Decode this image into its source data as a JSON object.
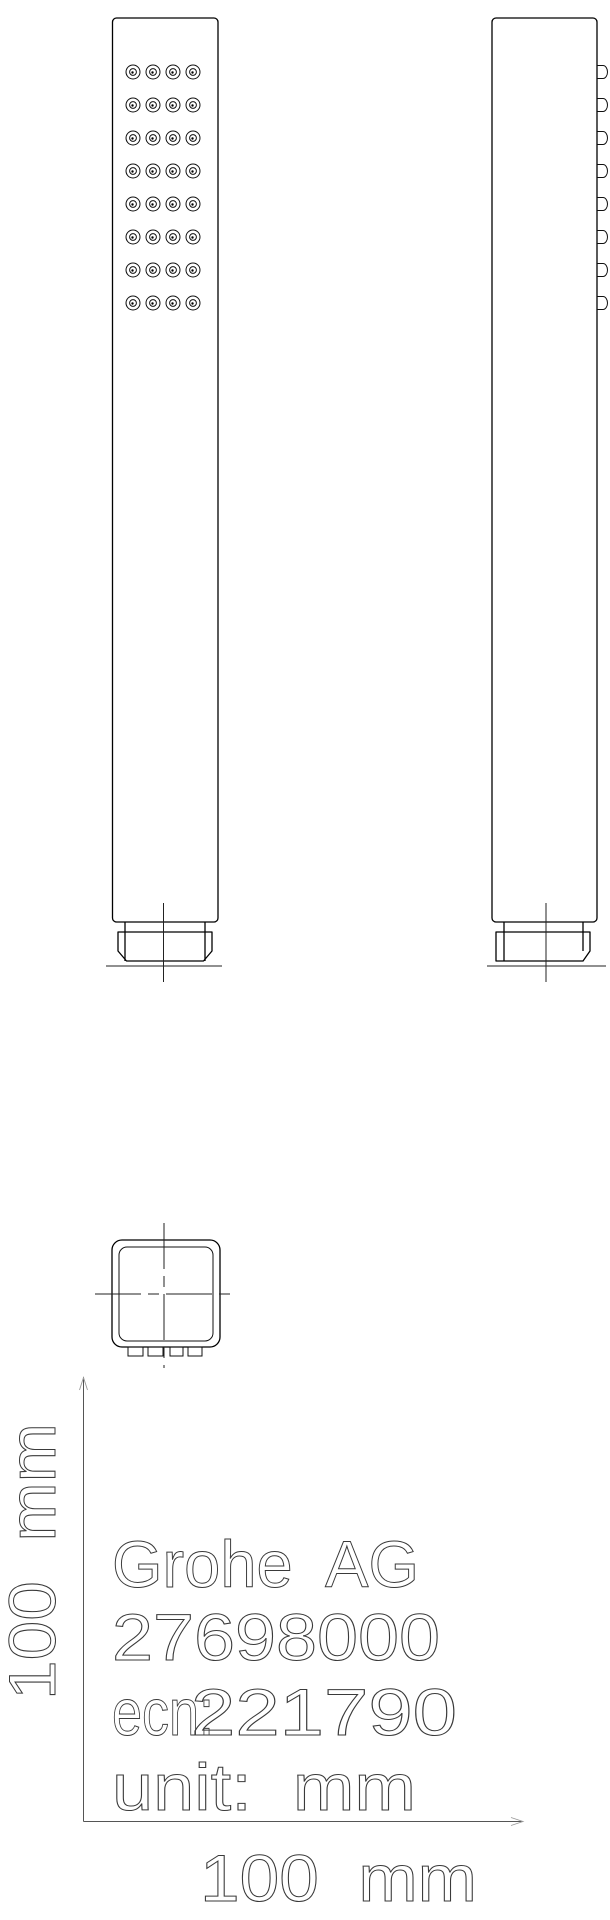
{
  "colors": {
    "line": "#000000",
    "text_stroke": "#3a3a3a",
    "dimension_line": "#555555",
    "background": "#ffffff"
  },
  "labels": {
    "brand": "Grohe  AG",
    "product_number": "27698000",
    "ecn_prefix": "ecn:",
    "ecn_value": "221790",
    "unit": "unit:  mm",
    "dim_horizontal": "100  mm",
    "dim_vertical": "100  mm"
  },
  "front_view": {
    "nozzle_grid": {
      "rows": 8,
      "cols": 4,
      "row_ys": [
        72,
        105,
        138,
        171,
        204,
        237,
        270,
        303
      ],
      "col_xs": [
        133,
        153,
        173,
        193
      ],
      "outer_r": 7,
      "inner_r": 3.4,
      "dot_r": 1.2
    }
  },
  "side_view": {
    "nozzle_profiles": {
      "ys": [
        72,
        105,
        138,
        171,
        204,
        237,
        270,
        303
      ],
      "x": 597,
      "width": 11,
      "height": 13
    }
  }
}
